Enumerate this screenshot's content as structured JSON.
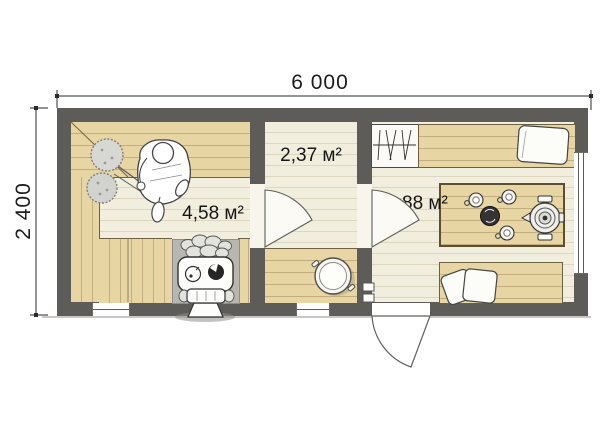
{
  "plan": {
    "type": "floor-plan",
    "overall_dimensions": {
      "width_label": "6 000",
      "height_label": "2 400"
    },
    "rooms": [
      {
        "id": "sauna",
        "area_label": "4,58 м²"
      },
      {
        "id": "washroom",
        "area_label": "2,37 м²"
      },
      {
        "id": "lounge",
        "area_label": "4,88 м²"
      }
    ],
    "fixtures": [
      "stove-with-stones",
      "seated-bather",
      "birch-whisk",
      "benches",
      "wash-basin",
      "wardrobe-with-hangers",
      "bed-with-pillow",
      "table-with-samovar-and-cups",
      "bed-with-pillows",
      "interior-doors",
      "entry-door",
      "windows"
    ],
    "colors": {
      "wall": "#5d5c59",
      "wood_bench": "#e8d5a4",
      "floor": "#f2eedd",
      "stove_niche": "#b7b6b2",
      "background": "#ffffff"
    }
  }
}
